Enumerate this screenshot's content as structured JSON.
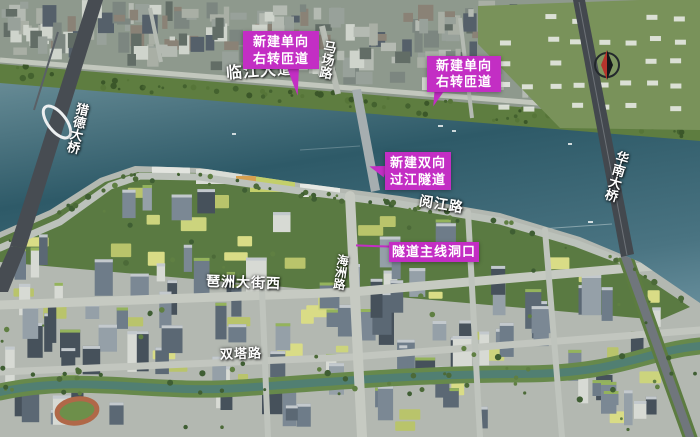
{
  "labels": {
    "linjiang_avenue": "临江大道",
    "machang_road": "马场路",
    "liede_bridge": "猎德大桥",
    "huanan_bridge": "华南大桥",
    "yuejiang_road": "阅江路",
    "haizhou_road": "海洲路",
    "pazhou_street_west": "琶洲大街西",
    "shuangta_road": "双塔路"
  },
  "callouts": [
    {
      "line1": "新建单向",
      "line2": "右转匝道"
    },
    {
      "line1": "新建单向",
      "line2": "右转匝道"
    },
    {
      "line1": "新建双向",
      "line2": "过江隧道"
    },
    {
      "text": "隧道主线洞口"
    }
  ],
  "icons": {
    "compass": "compass-north-icon"
  },
  "colors": {
    "callout_magenta": "#c32ec4",
    "label_text": "#ffffff",
    "river_deep": "#2e5a68",
    "river_light": "#8aa7ae",
    "north_bank": "#8e998d",
    "south_bank": "#b3b8b1",
    "vegetation": "#5e7d40",
    "bridge_deck": "#474c52"
  }
}
